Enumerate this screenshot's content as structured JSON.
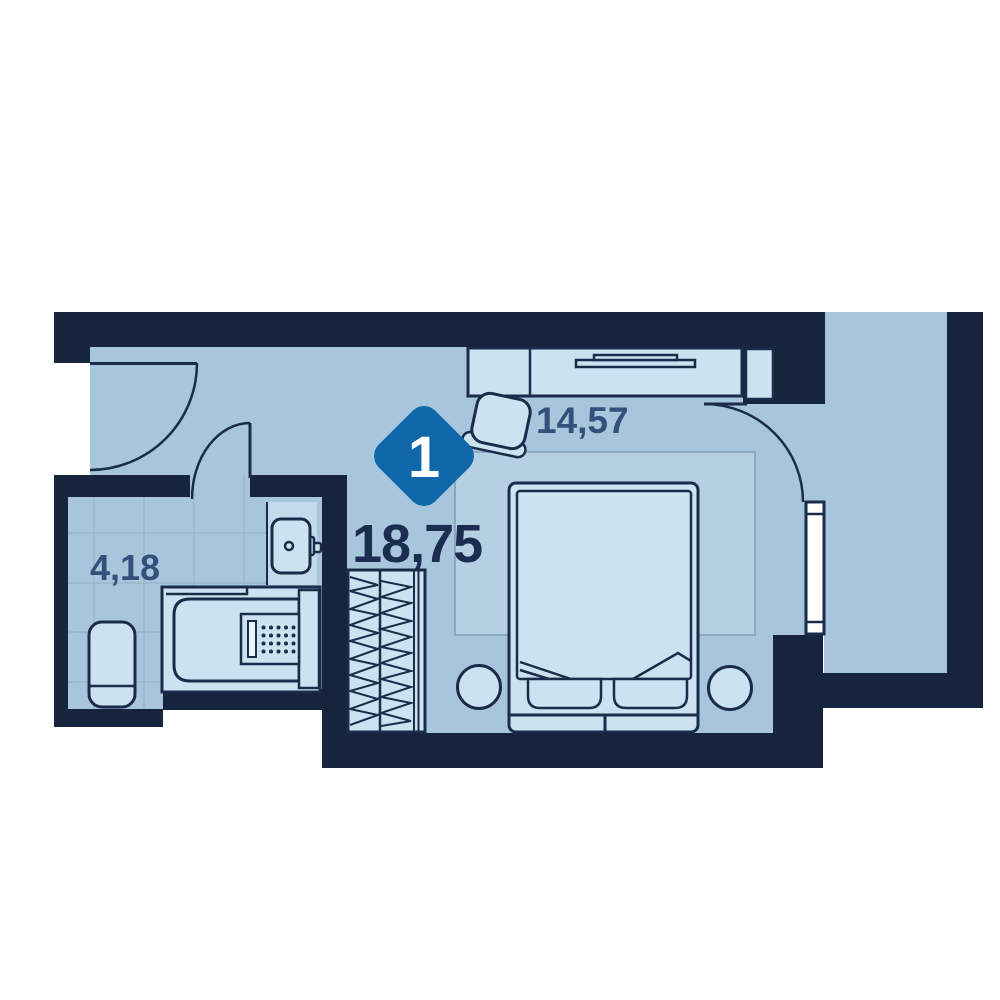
{
  "floorplan": {
    "badge": {
      "rooms": "1"
    },
    "labels": {
      "total_area": "18,75",
      "room_area": "14,57",
      "bathroom_area": "4,18"
    },
    "colors": {
      "wall": "#16243E",
      "floor": "#A7C6DB",
      "furniture": "#CDE2F1",
      "outline": "#1B2B4A",
      "rug": "#B5D0E2",
      "rug_border": "#7E9DB6",
      "tile_line": "#9AB5C9",
      "vanity": "#C2DAEB",
      "window": "#FFFFFF",
      "accent": "#0E67A9",
      "label_dark": "#1B2E52",
      "label_muted": "#33517C"
    }
  }
}
